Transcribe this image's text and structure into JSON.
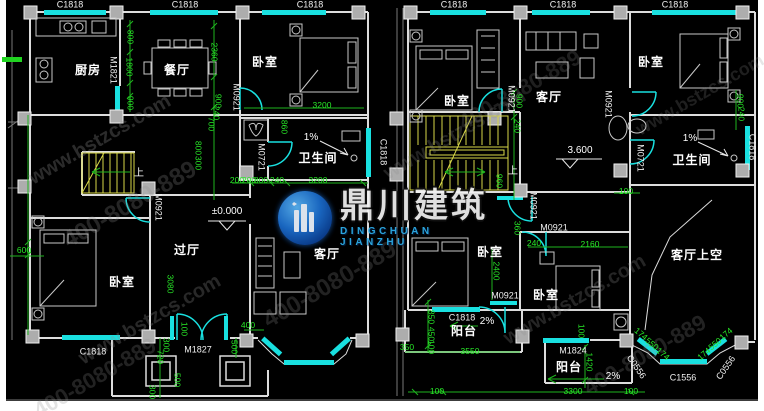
{
  "logo": {
    "name": "鼎川建筑",
    "sub": "DINGCHUAN JIANZHU"
  },
  "watermark": {
    "site": "www.bstzcs.com",
    "phone": "400-8080-889",
    "tiles": [
      {
        "k": "site",
        "x": 100,
        "y": 140,
        "s": 20,
        "o": 0.3
      },
      {
        "k": "phone",
        "x": 130,
        "y": 205,
        "s": 24,
        "o": 0.26
      },
      {
        "k": "site",
        "x": 150,
        "y": 320,
        "s": 20,
        "o": 0.28
      },
      {
        "k": "phone",
        "x": 95,
        "y": 378,
        "s": 22,
        "o": 0.24
      },
      {
        "k": "phone",
        "x": 330,
        "y": 285,
        "s": 24,
        "o": 0.24
      },
      {
        "k": "site",
        "x": 455,
        "y": 135,
        "s": 20,
        "o": 0.24
      },
      {
        "k": "phone",
        "x": 520,
        "y": 90,
        "s": 22,
        "o": 0.22
      },
      {
        "k": "site",
        "x": 575,
        "y": 300,
        "s": 20,
        "o": 0.26
      },
      {
        "k": "phone",
        "x": 645,
        "y": 355,
        "s": 22,
        "o": 0.24
      },
      {
        "k": "site",
        "x": 700,
        "y": 95,
        "s": 18,
        "o": 0.22
      }
    ]
  },
  "colors": {
    "background": "#000000",
    "walls": "#dcdcdc",
    "windows": "#19e0e0",
    "dimensions": "#27e827",
    "stairs": "#d8d848",
    "columns": "#adadad",
    "logo_blue": "#1c6fd0",
    "logo_sub": "#2fb2ef"
  },
  "labels": {
    "rooms": [
      {
        "t": "厨房",
        "x": 88,
        "y": 70
      },
      {
        "t": "餐厅",
        "x": 177,
        "y": 70
      },
      {
        "t": "卧室",
        "x": 265,
        "y": 62
      },
      {
        "t": "卧室",
        "x": 457,
        "y": 101
      },
      {
        "t": "卫生间",
        "x": 318,
        "y": 158
      },
      {
        "t": "过厅",
        "x": 187,
        "y": 250
      },
      {
        "t": "卧室",
        "x": 122,
        "y": 282
      },
      {
        "t": "客厅",
        "x": 327,
        "y": 254
      },
      {
        "t": "客厅",
        "x": 549,
        "y": 97
      },
      {
        "t": "卧室",
        "x": 651,
        "y": 62
      },
      {
        "t": "卫生间",
        "x": 692,
        "y": 160
      },
      {
        "t": "卧室",
        "x": 490,
        "y": 252
      },
      {
        "t": "卧室",
        "x": 546,
        "y": 295
      },
      {
        "t": "客厅上空",
        "x": 697,
        "y": 255
      },
      {
        "t": "阳台",
        "x": 464,
        "y": 331
      },
      {
        "t": "阳台",
        "x": 569,
        "y": 367
      }
    ],
    "tags": [
      {
        "t": "C1818",
        "x": 70,
        "y": 5
      },
      {
        "t": "C1818",
        "x": 185,
        "y": 5
      },
      {
        "t": "C1818",
        "x": 310,
        "y": 5
      },
      {
        "t": "C1818",
        "x": 454,
        "y": 5
      },
      {
        "t": "C1818",
        "x": 563,
        "y": 5
      },
      {
        "t": "C1818",
        "x": 675,
        "y": 5
      },
      {
        "t": "C1818",
        "x": 93,
        "y": 352
      },
      {
        "t": "C1818",
        "x": 462,
        "y": 318
      },
      {
        "t": "C1818",
        "x": 383,
        "y": 152,
        "r": 90
      },
      {
        "t": "C1818",
        "x": 752,
        "y": 147,
        "r": 90
      },
      {
        "t": "C1556",
        "x": 683,
        "y": 378
      },
      {
        "t": "C0556",
        "x": 636,
        "y": 367,
        "r": 55
      },
      {
        "t": "C0556",
        "x": 726,
        "y": 368,
        "r": -55
      },
      {
        "t": "M1821",
        "x": 113,
        "y": 70,
        "r": 90
      },
      {
        "t": "M0921",
        "x": 236,
        "y": 97,
        "r": 90
      },
      {
        "t": "M0721",
        "x": 261,
        "y": 157,
        "r": 90
      },
      {
        "t": "M0921",
        "x": 158,
        "y": 207,
        "r": 90
      },
      {
        "t": "M0921",
        "x": 533,
        "y": 206,
        "r": 90
      },
      {
        "t": "M0921",
        "x": 511,
        "y": 99,
        "r": 90
      },
      {
        "t": "M0721",
        "x": 640,
        "y": 158,
        "r": 90
      },
      {
        "t": "M0921",
        "x": 608,
        "y": 104,
        "r": 90
      },
      {
        "t": "M0921",
        "x": 554,
        "y": 228
      },
      {
        "t": "M0921",
        "x": 505,
        "y": 296
      },
      {
        "t": "M1827",
        "x": 198,
        "y": 350
      },
      {
        "t": "M1824",
        "x": 573,
        "y": 351
      }
    ],
    "dims": [
      {
        "t": "800",
        "x": 130,
        "y": 37,
        "r": 90
      },
      {
        "t": "1800",
        "x": 129,
        "y": 67,
        "r": 90
      },
      {
        "t": "900",
        "x": 130,
        "y": 103,
        "r": 90
      },
      {
        "t": "2360",
        "x": 214,
        "y": 52,
        "r": 90
      },
      {
        "t": "900",
        "x": 218,
        "y": 101,
        "r": 90
      },
      {
        "t": "240",
        "x": 216,
        "y": 113,
        "r": 90
      },
      {
        "t": "700",
        "x": 211,
        "y": 124,
        "r": 90
      },
      {
        "t": "800",
        "x": 198,
        "y": 148,
        "r": 90
      },
      {
        "t": "300",
        "x": 198,
        "y": 163,
        "r": 90
      },
      {
        "t": "200",
        "x": 237,
        "y": 180
      },
      {
        "t": "200",
        "x": 249,
        "y": 180
      },
      {
        "t": "800",
        "x": 261,
        "y": 180
      },
      {
        "t": "240",
        "x": 277,
        "y": 180
      },
      {
        "t": "3200",
        "x": 318,
        "y": 180
      },
      {
        "t": "860",
        "x": 284,
        "y": 127,
        "r": 90
      },
      {
        "t": "3200",
        "x": 322,
        "y": 105
      },
      {
        "t": "600",
        "x": 24,
        "y": 250
      },
      {
        "t": "3080",
        "x": 170,
        "y": 284,
        "r": 90
      },
      {
        "t": "100",
        "x": 184,
        "y": 329,
        "r": 90
      },
      {
        "t": "300",
        "x": 166,
        "y": 345,
        "r": 90
      },
      {
        "t": "720",
        "x": 160,
        "y": 357,
        "r": 90
      },
      {
        "t": "500",
        "x": 177,
        "y": 380,
        "r": 90
      },
      {
        "t": "300",
        "x": 152,
        "y": 392,
        "r": 90
      },
      {
        "t": "400",
        "x": 248,
        "y": 325
      },
      {
        "t": "500",
        "x": 234,
        "y": 347,
        "r": 90
      },
      {
        "t": "900",
        "x": 519,
        "y": 101,
        "r": 90
      },
      {
        "t": "240",
        "x": 517,
        "y": 126,
        "r": 90
      },
      {
        "t": "960",
        "x": 499,
        "y": 181,
        "r": 90
      },
      {
        "t": "360",
        "x": 517,
        "y": 228,
        "r": 90
      },
      {
        "t": "240",
        "x": 534,
        "y": 243
      },
      {
        "t": "2160",
        "x": 590,
        "y": 244
      },
      {
        "t": "2400",
        "x": 496,
        "y": 271,
        "r": 90
      },
      {
        "t": "100",
        "x": 626,
        "y": 191
      },
      {
        "t": "900",
        "x": 740,
        "y": 101,
        "r": 90
      },
      {
        "t": "240",
        "x": 741,
        "y": 114,
        "r": 90
      },
      {
        "t": "350",
        "x": 407,
        "y": 347
      },
      {
        "t": "850",
        "x": 431,
        "y": 317,
        "r": 90
      },
      {
        "t": "450",
        "x": 431,
        "y": 334,
        "r": 90
      },
      {
        "t": "100",
        "x": 431,
        "y": 347,
        "r": 90
      },
      {
        "t": "3550",
        "x": 470,
        "y": 351
      },
      {
        "t": "100",
        "x": 581,
        "y": 331,
        "r": 90
      },
      {
        "t": "1420",
        "x": 589,
        "y": 362,
        "r": 90
      },
      {
        "t": "100",
        "x": 437,
        "y": 391
      },
      {
        "t": "3300",
        "x": 573,
        "y": 391
      },
      {
        "t": "100",
        "x": 631,
        "y": 391
      },
      {
        "t": "174",
        "x": 641,
        "y": 334,
        "r": 40
      },
      {
        "t": "550",
        "x": 652,
        "y": 344,
        "r": 40
      },
      {
        "t": "174",
        "x": 663,
        "y": 354,
        "r": 40
      },
      {
        "t": "174",
        "x": 726,
        "y": 334,
        "r": -40
      },
      {
        "t": "550",
        "x": 715,
        "y": 344,
        "r": -40
      },
      {
        "t": "174",
        "x": 704,
        "y": 354,
        "r": -40
      }
    ],
    "marks": [
      {
        "t": "±0.000",
        "x": 227,
        "y": 212
      },
      {
        "t": "3.600",
        "x": 580,
        "y": 151
      },
      {
        "t": "上",
        "x": 139,
        "y": 174
      },
      {
        "t": "上",
        "x": 513,
        "y": 172
      },
      {
        "t": "1%",
        "x": 311,
        "y": 138
      },
      {
        "t": "1%",
        "x": 690,
        "y": 139
      },
      {
        "t": "2%",
        "x": 487,
        "y": 322
      },
      {
        "t": "2%",
        "x": 613,
        "y": 377
      }
    ]
  }
}
